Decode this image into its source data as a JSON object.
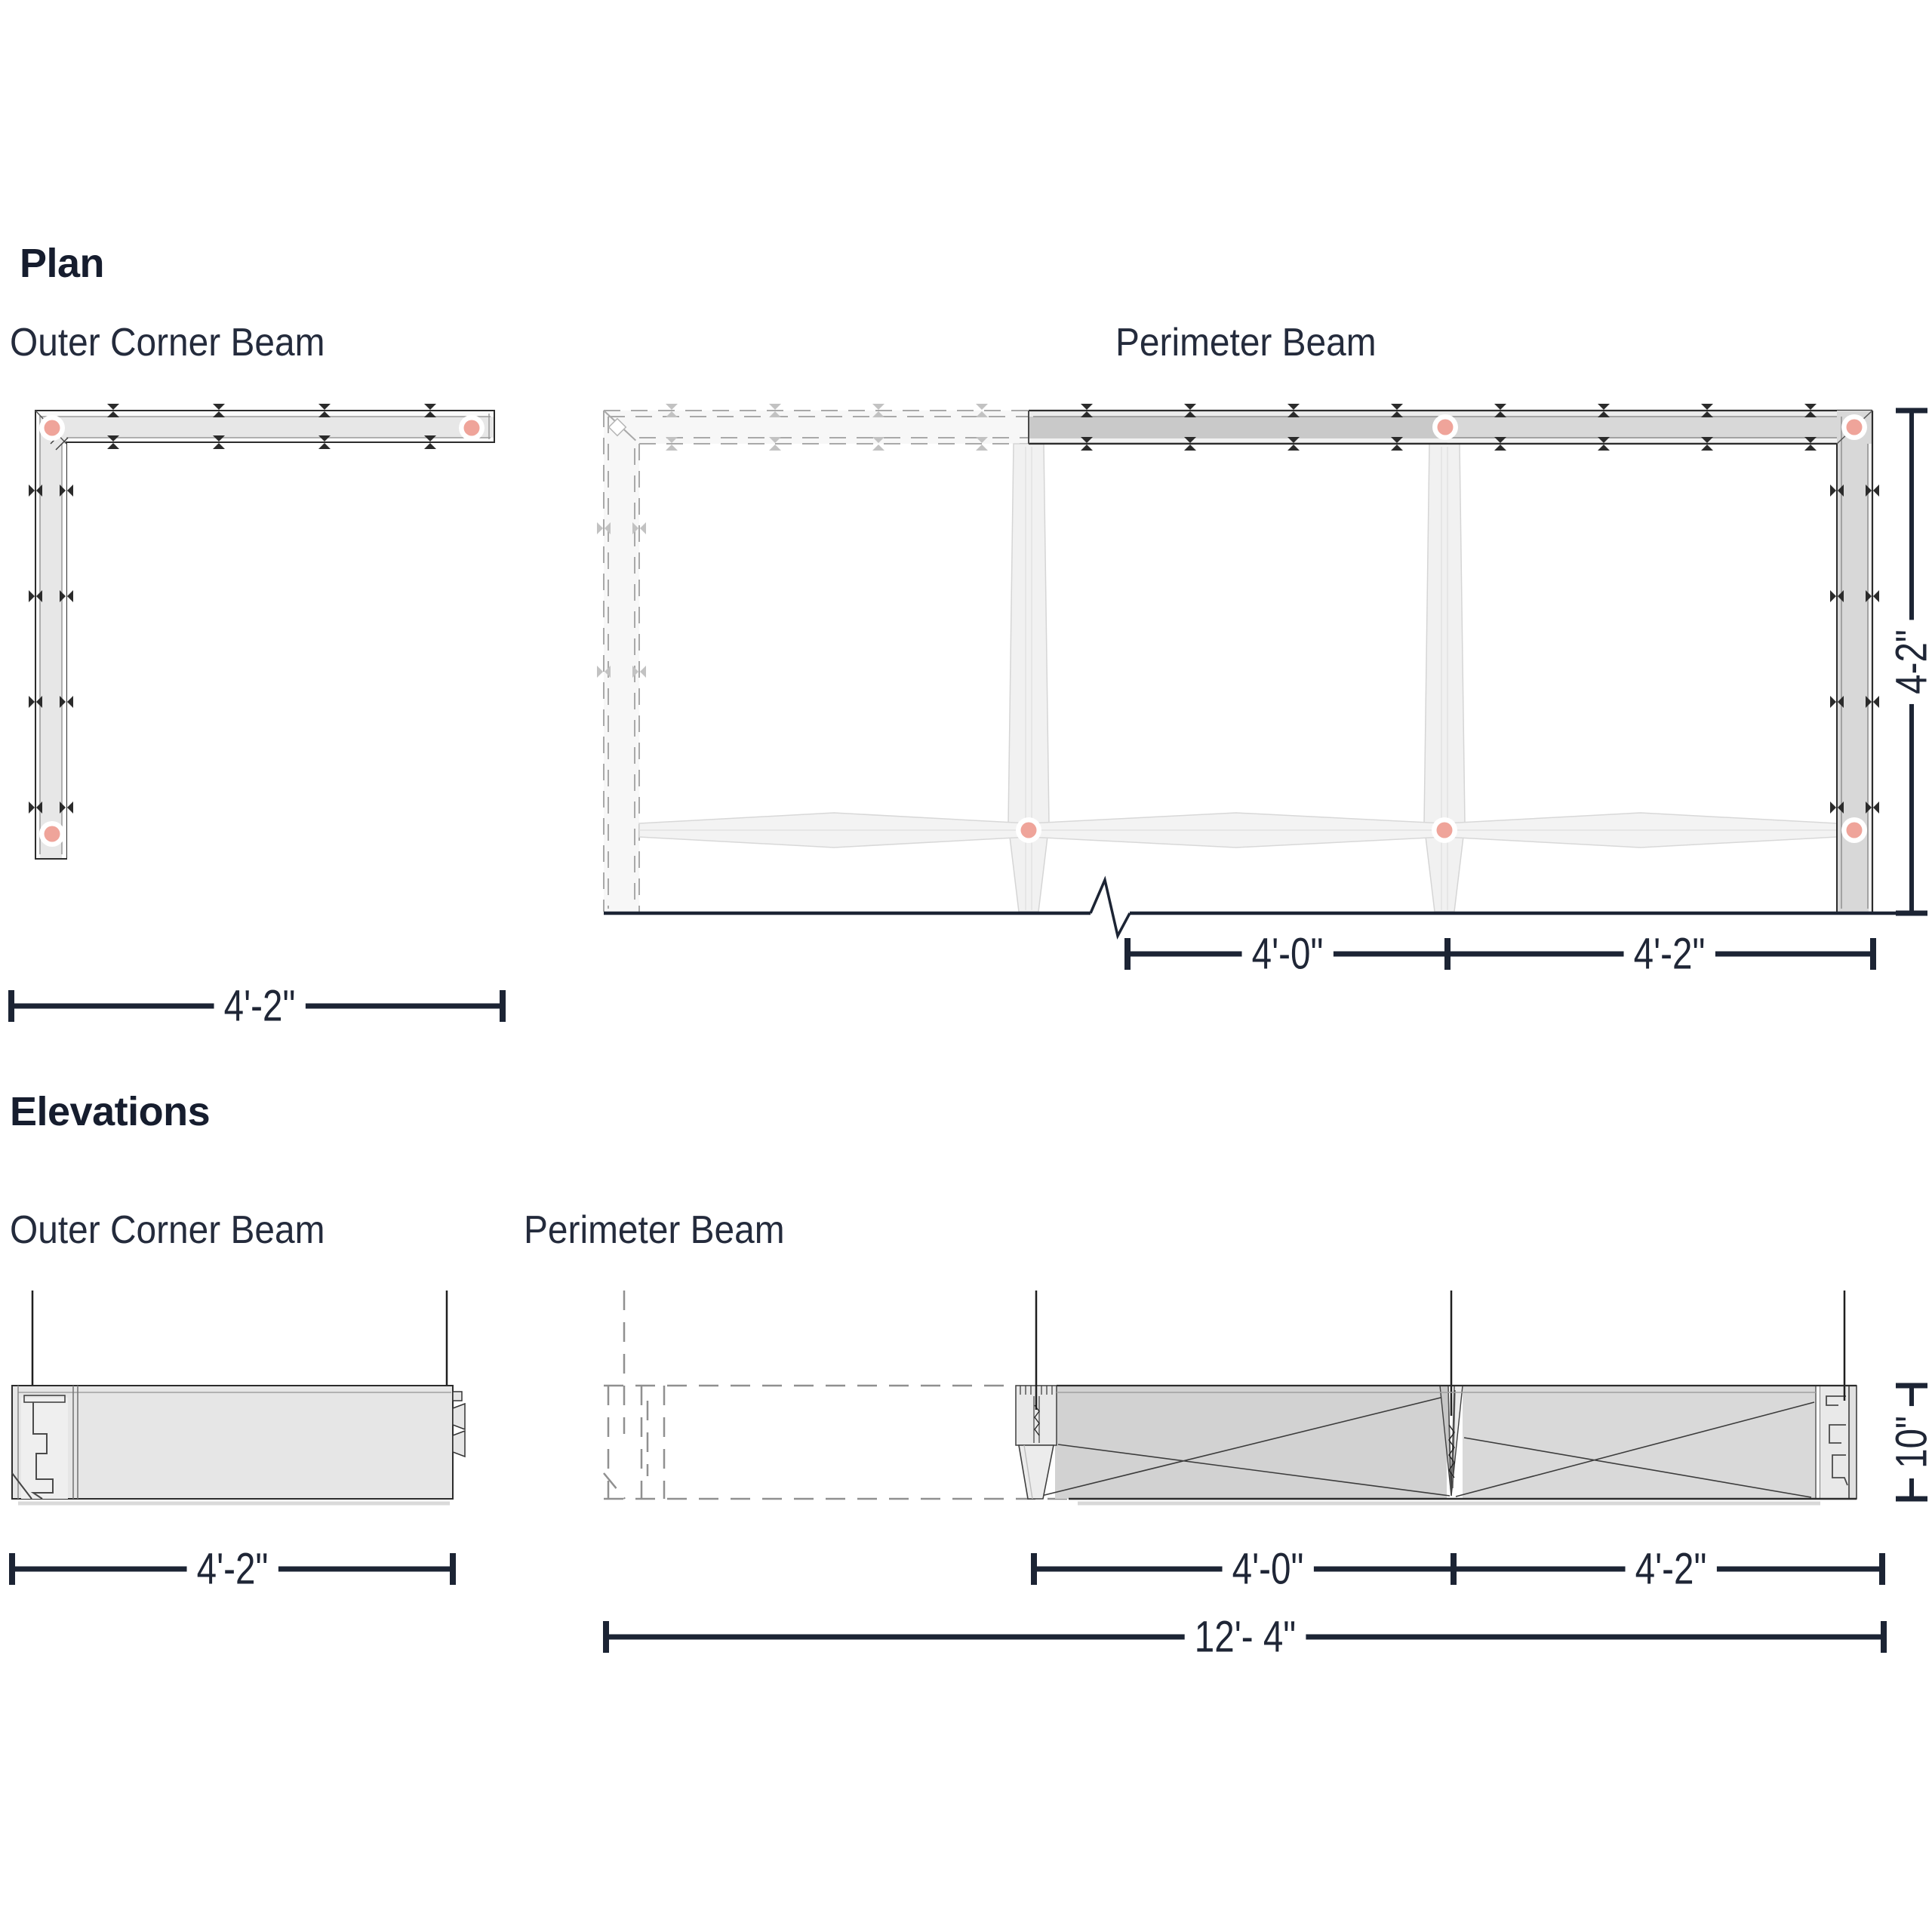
{
  "colors": {
    "accent_pink": "#efa49a",
    "ink": "#1c2434",
    "text": "#242b3c"
  },
  "plan": {
    "heading": "Plan",
    "outer_corner": {
      "label": "Outer Corner Beam",
      "width_dim": "4'-2\""
    },
    "perimeter": {
      "label": "Perimeter Beam",
      "bay_dims": [
        "4'-0\"",
        "4'-2\""
      ],
      "depth_dim": "4-2\""
    }
  },
  "elevations": {
    "heading": "Elevations",
    "outer_corner": {
      "label": "Outer Corner Beam",
      "width_dim": "4'-2\""
    },
    "perimeter": {
      "label": "Perimeter Beam",
      "bay_dims": [
        "4'-0\"",
        "4'-2\""
      ],
      "overall_dim": "12'- 4\"",
      "height_dim": "10\""
    }
  }
}
